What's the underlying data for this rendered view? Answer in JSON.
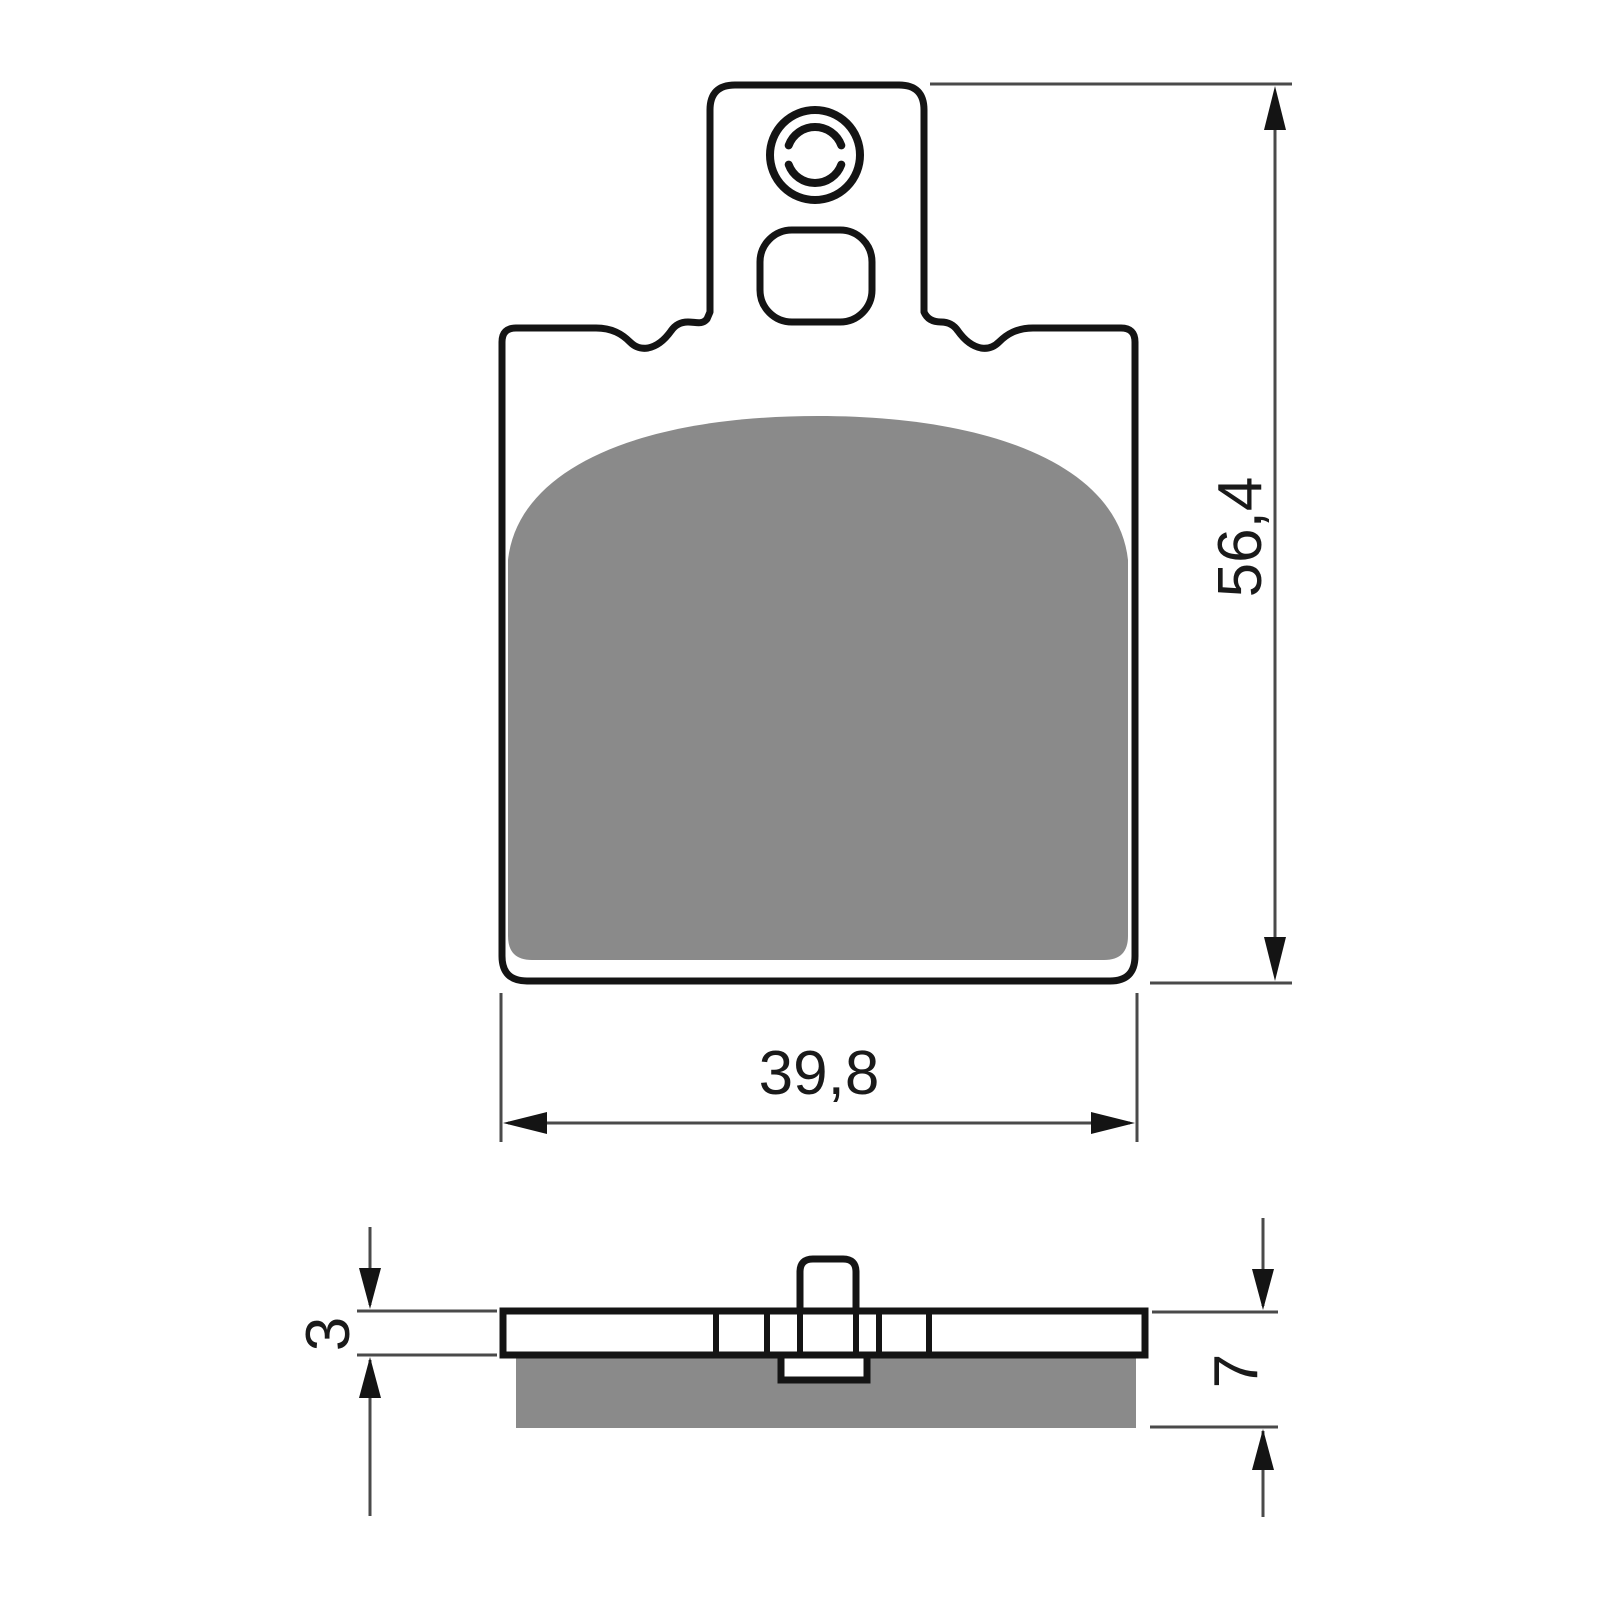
{
  "drawing": {
    "dimensions": {
      "pad_height": "56,4",
      "pad_width": "39,8",
      "backplate_thickness": "3",
      "total_thickness": "7"
    },
    "colors": {
      "friction": "#8a8a8a",
      "outline": "#141414",
      "dim_line": "#4a4a4a",
      "background": "#ffffff"
    }
  }
}
